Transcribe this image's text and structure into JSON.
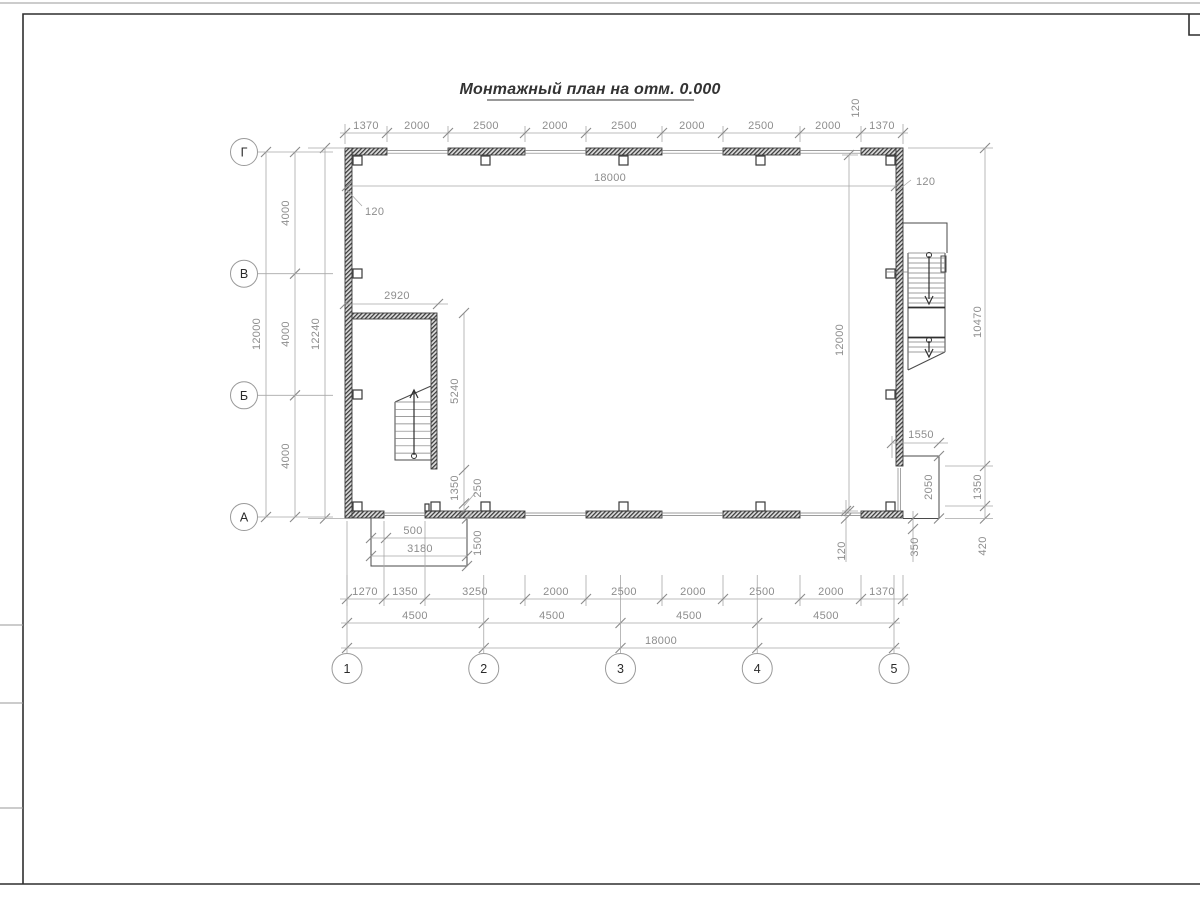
{
  "title": "Монтажный план на отм. 0.000",
  "axes": {
    "rows": [
      "Г",
      "В",
      "Б",
      "А"
    ],
    "cols": [
      "1",
      "2",
      "3",
      "4",
      "5"
    ]
  },
  "dims": {
    "top": [
      "1370",
      "2000",
      "2500",
      "2000",
      "2500",
      "2000",
      "2500",
      "2000",
      "1370"
    ],
    "top_offset": "120",
    "inner_width": "18000",
    "wall_offset_left": "120",
    "wall_offset_right": "120",
    "left": {
      "spans": [
        "4000",
        "4000",
        "4000"
      ],
      "total": "12000",
      "outer": "12240"
    },
    "right": {
      "total": "12000",
      "upper": "10470",
      "mid": "1350",
      "lower": "420",
      "offset": "120"
    },
    "landing": {
      "width": "1550",
      "depth": "2050",
      "offset": "350"
    },
    "stairwell": {
      "width": "2920",
      "depth": "5240",
      "below": "1350",
      "gap": "250"
    },
    "porch": {
      "offset": "500",
      "width": "3180",
      "depth": "1500"
    },
    "bottom": [
      "1270",
      "1350",
      "3250",
      "2000",
      "2500",
      "2000",
      "2500",
      "2000",
      "1370"
    ],
    "spans": [
      "4500",
      "4500",
      "4500",
      "4500"
    ],
    "total": "18000"
  }
}
